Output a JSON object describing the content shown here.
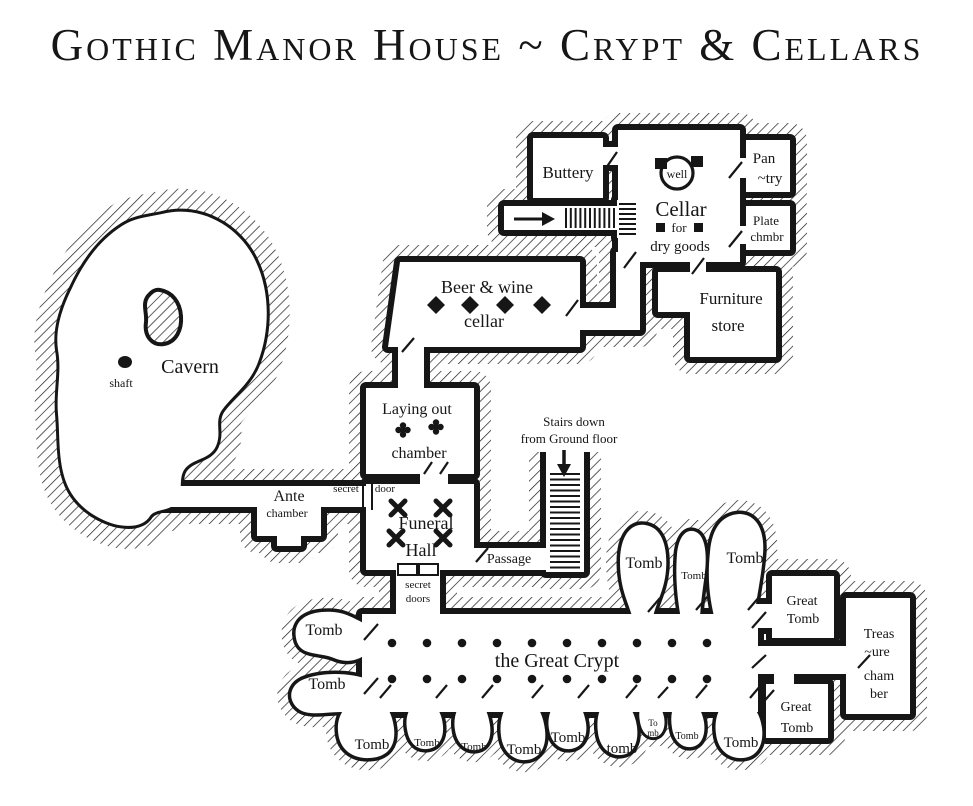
{
  "title": "Gothic Manor House ~ Crypt & Cellars",
  "rooms": {
    "buttery": "Buttery",
    "cellar": {
      "name": "Cellar",
      "for_word": "for",
      "goods": "dry goods",
      "well": "well"
    },
    "pantry": {
      "l1": "Pan",
      "l2": "~try"
    },
    "plate": {
      "l1": "Plate",
      "l2": "chmbr"
    },
    "furniture": {
      "l1": "Furniture",
      "l2": "store"
    },
    "beer": {
      "l1": "Beer & wine",
      "l2": "cellar"
    },
    "cavern": {
      "name": "Cavern",
      "shaft": "shaft"
    },
    "laying": {
      "l1": "Laying out",
      "l2": "chamber"
    },
    "stairs": {
      "l1": "Stairs down",
      "l2": "from Ground floor"
    },
    "ante": {
      "l1": "Ante",
      "l2": "chamber"
    },
    "secret_door": {
      "l1": "secret",
      "l2": "door"
    },
    "funeral": {
      "l1": "Funeral",
      "l2": "Hall"
    },
    "passage": "Passage",
    "secret_doors": {
      "l1": "secret",
      "l2": "doors"
    },
    "crypt": "the Great Crypt",
    "treasure": {
      "l1": "Treas",
      "l2": "~ure",
      "l3": "cham",
      "l4": "ber"
    },
    "great_tomb_upper": {
      "l1": "Great",
      "l2": "Tomb"
    },
    "great_tomb_lower": {
      "l1": "Great",
      "l2": "Tomb"
    },
    "tombs": {
      "left1": "Tomb",
      "left2": "Tomb",
      "up1": "Tomb",
      "up2": "Tomb",
      "up3": "Tomb",
      "b1": "Tomb",
      "b2": "Tomb",
      "b3": "Tomb",
      "b4": "Tomb",
      "b5": "Tomb",
      "b6": "tomb",
      "b7a": "To",
      "b7b": "mb",
      "b8": "Tomb",
      "b9": "Tomb"
    }
  }
}
